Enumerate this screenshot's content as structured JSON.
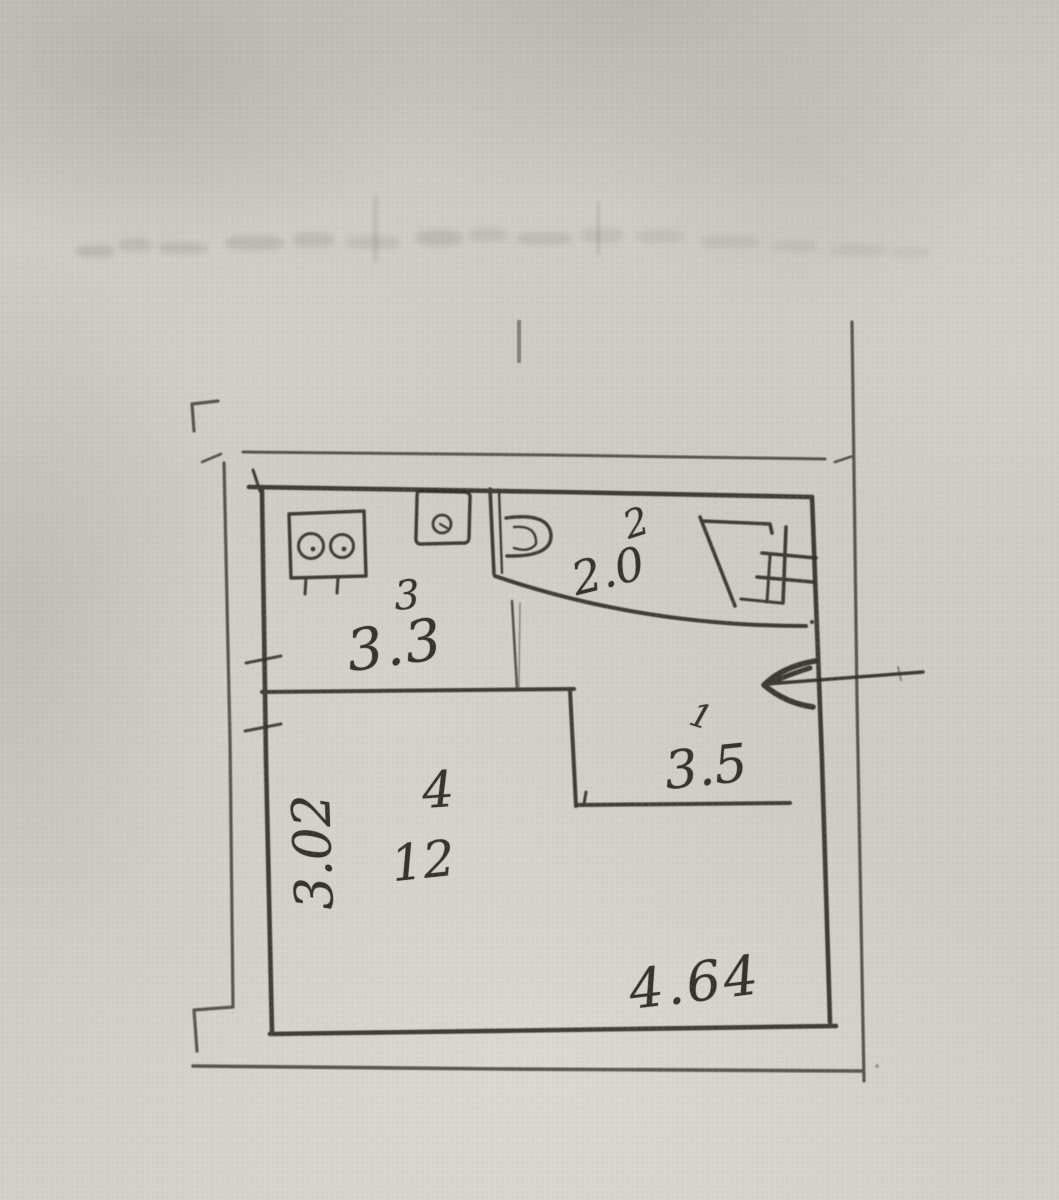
{
  "plan": {
    "rooms": [
      {
        "number": "1",
        "dimension": "3.5"
      },
      {
        "number": "2",
        "dimension": "2.0"
      },
      {
        "number": "3",
        "dimension": "3.3"
      },
      {
        "number": "4",
        "area": "12"
      }
    ],
    "overall_dimensions": {
      "left_height": "3.02",
      "bottom_width": "4.64"
    },
    "colors": {
      "paper": "#cfccc5",
      "ink": "#312d26"
    },
    "icons": [
      "stove-icon",
      "sink-icon",
      "toilet-icon",
      "door-swing-icon",
      "radiator-hash-icon",
      "entrance-arrow-icon",
      "corner-mark-icon"
    ]
  }
}
